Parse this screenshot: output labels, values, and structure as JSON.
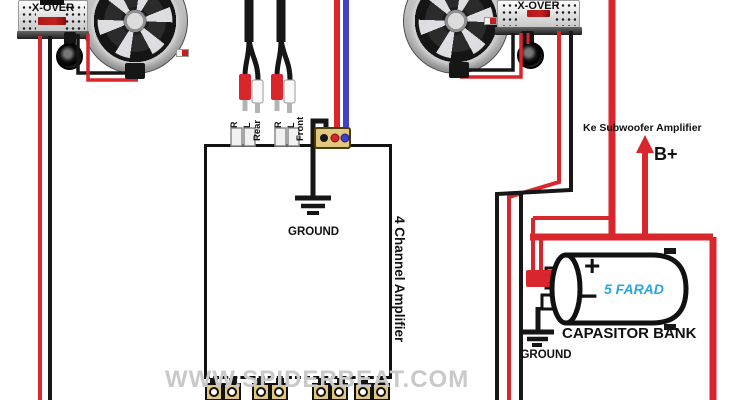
{
  "colors": {
    "wire_red": "#d8262c",
    "wire_black": "#161616",
    "wire_blue": "#4141c8",
    "terminal_gold": "#e2c87e",
    "farad_blue": "#29a6dc",
    "watermark_gray": "#c9c9c9",
    "badge_red": "#c42020"
  },
  "watermark": {
    "text": "WWW.SPIDERBEAT.COM"
  },
  "crossovers": {
    "left_label": "X-OVER",
    "right_label": "X-OVER"
  },
  "amplifier": {
    "name": "4 Channel Amplifier",
    "ground_label": "GROUND",
    "inputs": {
      "rear_label": "Rear",
      "front_label": "Front",
      "right_label": "R",
      "left_label": "L"
    }
  },
  "power": {
    "subwoofer_note": "Ke Subwoofer Amplifier",
    "battery_positive": "B+"
  },
  "capacitor": {
    "value": "5 FARAD",
    "label": "CAPASITOR BANK",
    "positive": "+",
    "negative": "−",
    "ground_label": "GROUND"
  }
}
